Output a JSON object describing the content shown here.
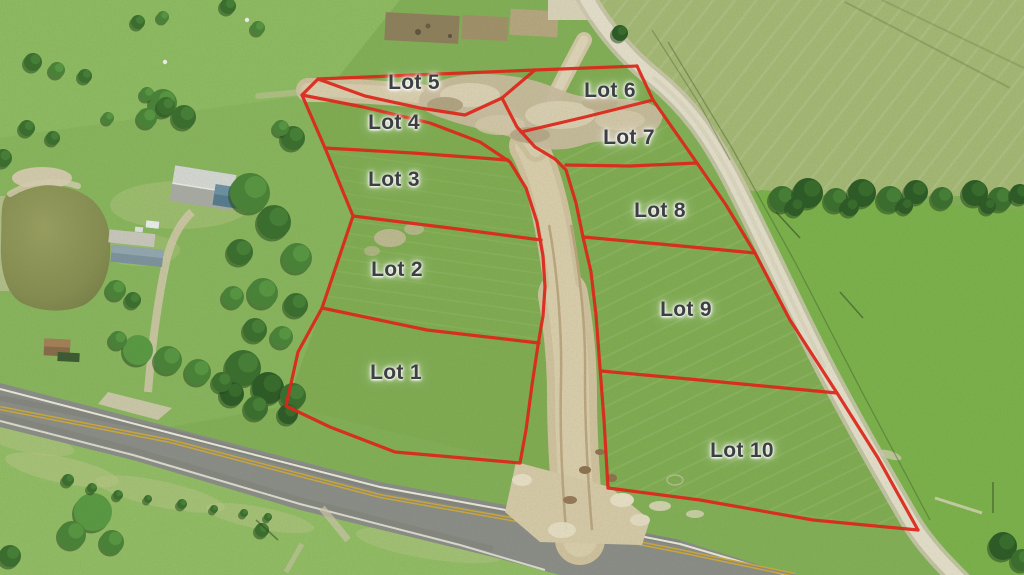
{
  "image_type": "aerial-photo-lot-plat",
  "lots": [
    {
      "label": "Lot 1",
      "x": 396,
      "y": 374
    },
    {
      "label": "Lot 2",
      "x": 397,
      "y": 271
    },
    {
      "label": "Lot 3",
      "x": 394,
      "y": 181
    },
    {
      "label": "Lot 4",
      "x": 394,
      "y": 124
    },
    {
      "label": "Lot 5",
      "x": 414,
      "y": 84
    },
    {
      "label": "Lot 6",
      "x": 610,
      "y": 92
    },
    {
      "label": "Lot 7",
      "x": 629,
      "y": 139
    },
    {
      "label": "Lot 8",
      "x": 660,
      "y": 212
    },
    {
      "label": "Lot 9",
      "x": 686,
      "y": 311
    },
    {
      "label": "Lot 10",
      "x": 742,
      "y": 452
    }
  ],
  "colors": {
    "boundary_line": "#dc271b",
    "label_text": "#3d3f44",
    "grass_base": "#84b058",
    "hay_field": "#a6b976",
    "dirt_road": "#d2c3a0",
    "gravel_road": "#e6e0cd",
    "paved_road": "#8c8d89",
    "center_stripe_yellow": "#cfa93b",
    "pond_water": "#8e9357"
  },
  "features": [
    "pond",
    "farm-buildings",
    "tree-line",
    "dirt-road",
    "gravel-county-road",
    "paved-highway",
    "tilled-garden-plots"
  ]
}
